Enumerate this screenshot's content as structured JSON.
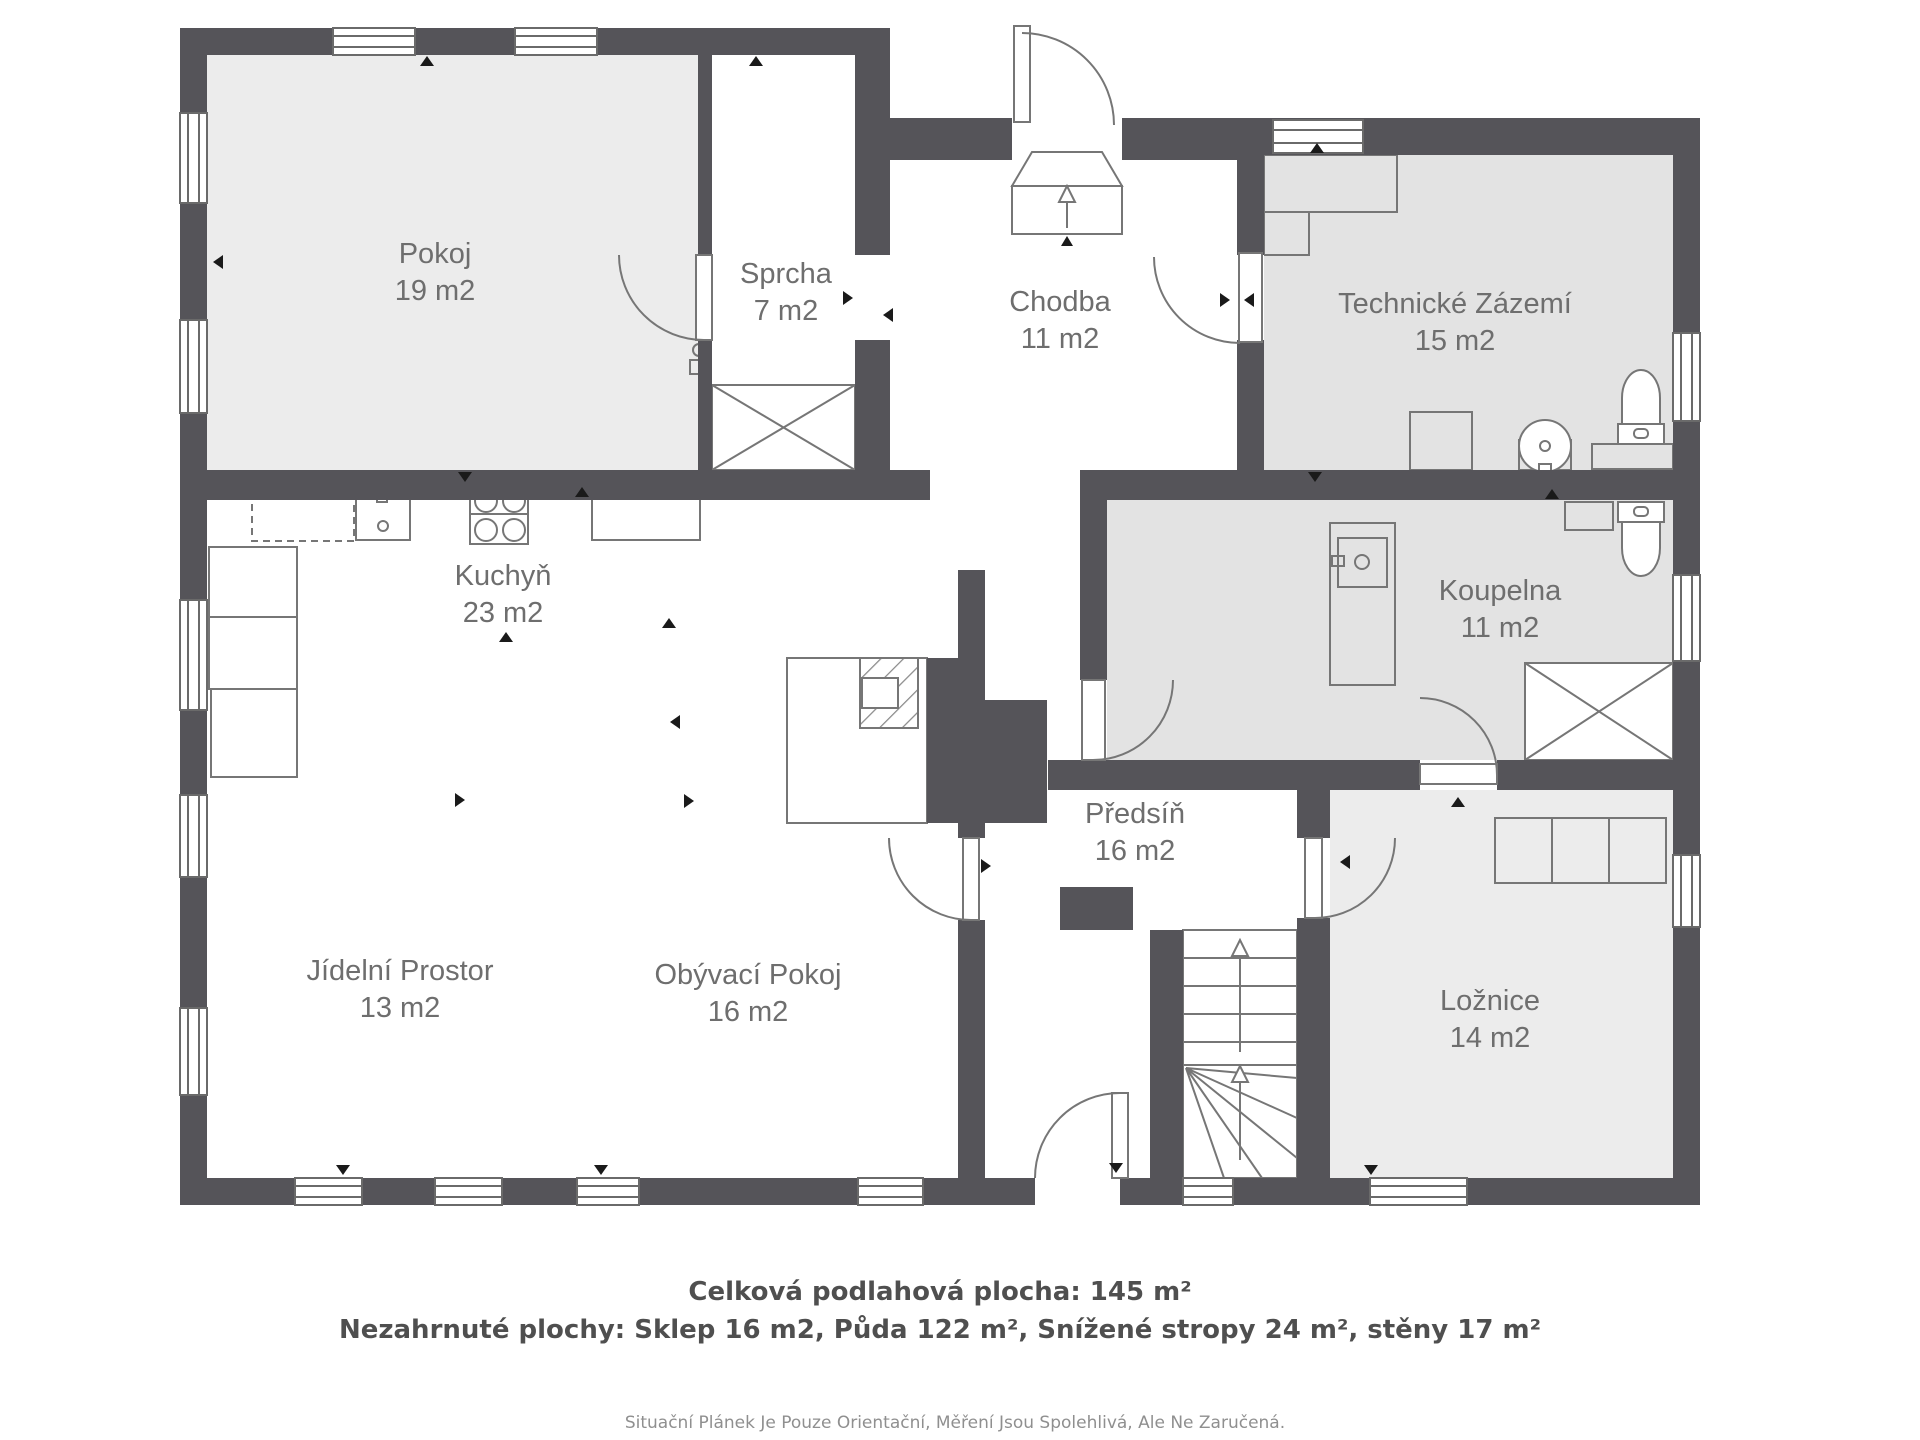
{
  "title": "Floor plan – ground floor",
  "colors": {
    "wall": "#555459",
    "room_light": "#ececec",
    "room_gray": "#e3e3e3",
    "line": "#767676",
    "label": "#6e6e6e"
  },
  "rooms": {
    "pokoj": {
      "name": "Pokoj",
      "area": "19 m2"
    },
    "sprcha": {
      "name": "Sprcha",
      "area": "7 m2"
    },
    "chodba": {
      "name": "Chodba",
      "area": "11 m2"
    },
    "tz": {
      "name": "Technické Zázemí",
      "area": "15 m2"
    },
    "kuchyn": {
      "name": "Kuchyň",
      "area": "23 m2"
    },
    "koupelna": {
      "name": "Koupelna",
      "area": "11 m2"
    },
    "predsin": {
      "name": "Předsíň",
      "area": "16 m2"
    },
    "jidelni": {
      "name": "Jídelní Prostor",
      "area": "13 m2"
    },
    "obyvaci": {
      "name": "Obývací Pokoj",
      "area": "16 m2"
    },
    "loznice": {
      "name": "Ložnice",
      "area": "14 m2"
    }
  },
  "summary": {
    "total": "Celková podlahová plocha: 145 m²",
    "excluded": "Nezahrnuté plochy: Sklep 16 m2, Půda 122 m², Snížené stropy 24 m², stěny 17 m²"
  },
  "disclaimer": "Situační Plánek Je Pouze Orientační, Měření Jsou Spolehlivá, Ale Ne Zaručená."
}
